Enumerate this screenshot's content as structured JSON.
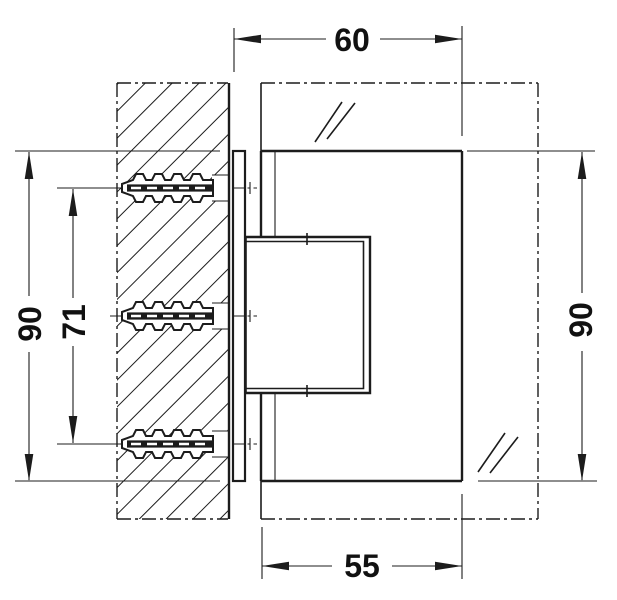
{
  "drawing": {
    "dimensions": {
      "top": "60",
      "bottom": "55",
      "left_outer": "90",
      "left_inner": "71",
      "right": "90"
    }
  }
}
